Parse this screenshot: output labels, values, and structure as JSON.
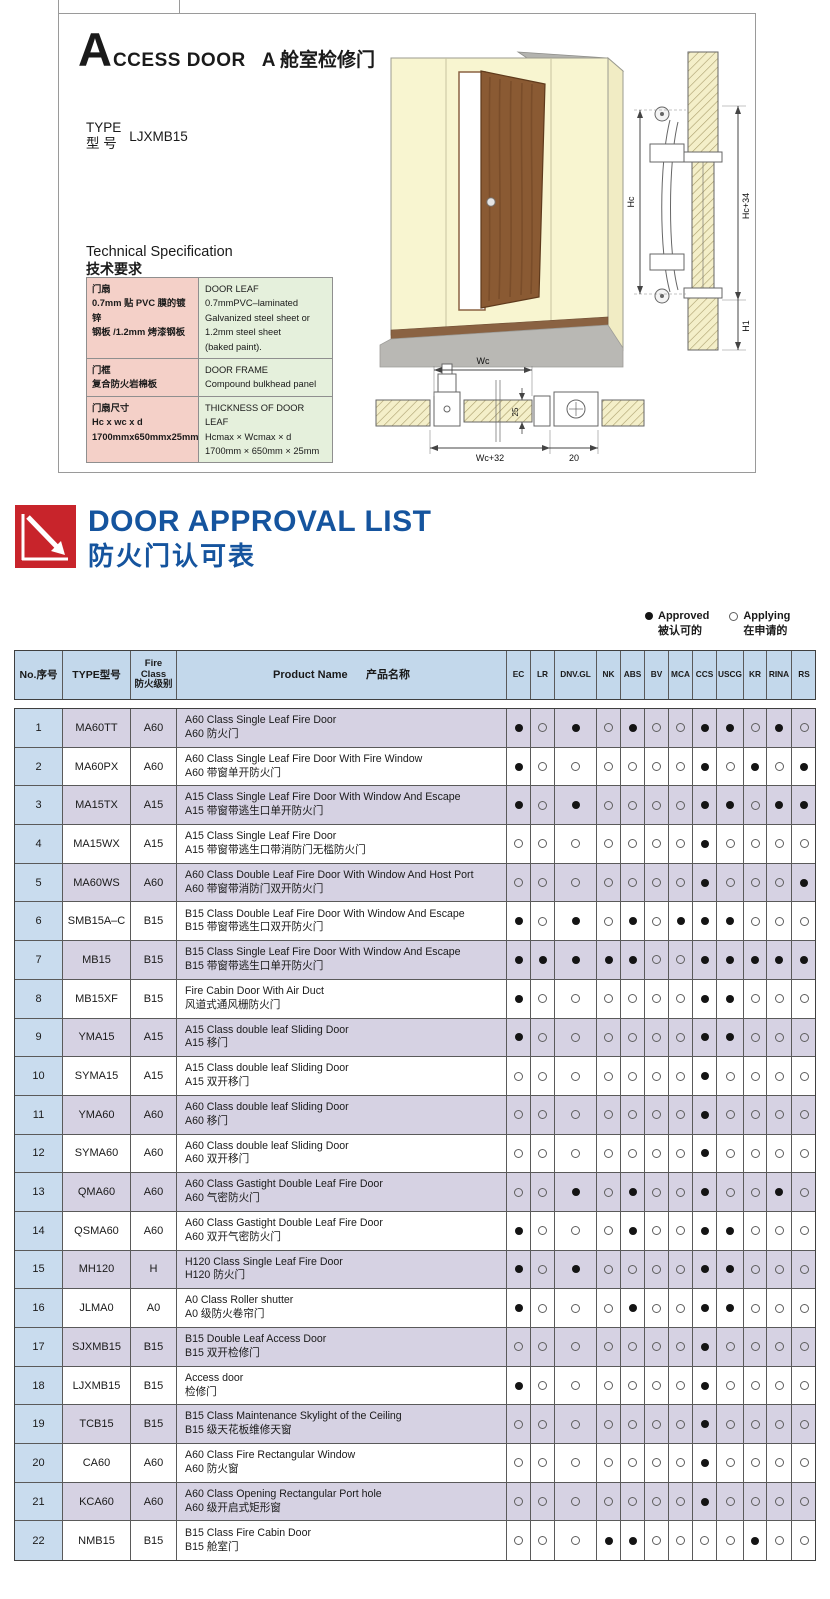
{
  "access_door": {
    "initial": "A",
    "title_en": "CCESS DOOR",
    "title_cn": "A 舱室检修门",
    "type_label_en": "TYPE",
    "type_label_cn": "型  号",
    "type_value": "LJXMB15",
    "spec_title_en": "Technical Specification",
    "spec_title_cn": "技术要求",
    "spec_rows": [
      {
        "cn": "门扇\n0.7mm 贴 PVC 膜的镀锌\n钢板 /1.2mm 烤漆钢板",
        "en": "DOOR LEAF\n0.7mmPVC–laminated\nGalvanized steel sheet or\n1.2mm steel sheet\n(baked paint)."
      },
      {
        "cn": "门框\n复合防火岩棉板",
        "en": "DOOR FRAME\nCompound bulkhead panel"
      },
      {
        "cn": "门扇尺寸\nHc x wc x d\n1700mmx650mmx25mm",
        "en": "THICKNESS OF DOOR LEAF\nHcmax × Wcmax × d\n1700mm × 650mm × 25mm"
      }
    ],
    "dims": {
      "hc": "Hc",
      "hc_plus": "Hc+34",
      "h1": "H1",
      "wc": "Wc",
      "thickness": "25",
      "wc_plus": "Wc+32",
      "edge": "20"
    }
  },
  "approval": {
    "title_en": "DOOR APPROVAL LIST",
    "title_cn": "防火门认可表",
    "legend": {
      "approved_en": "Approved",
      "approved_cn": "被认可的",
      "applying_en": "Applying",
      "applying_cn": "在申请的"
    },
    "header": {
      "no": "No.序号",
      "type": "TYPE型号",
      "fire_class": "Fire\nClass\n防火级别",
      "product": "Product Name      产品名称"
    },
    "certs": [
      "EC",
      "LR",
      "DNV.GL",
      "NK",
      "ABS",
      "BV",
      "MCA",
      "CCS",
      "USCG",
      "KR",
      "RINA",
      "RS"
    ],
    "rows": [
      {
        "no": "1",
        "type": "MA60TT",
        "fire": "A60",
        "en": "A60 Class Single Leaf Fire Door",
        "cn": "A60 防火门",
        "marks": [
          1,
          0,
          1,
          0,
          1,
          0,
          0,
          1,
          1,
          0,
          1,
          0
        ]
      },
      {
        "no": "2",
        "type": "MA60PX",
        "fire": "A60",
        "en": "A60 Class Single Leaf Fire Door With Fire Window",
        "cn": "A60 带窗单开防火门",
        "marks": [
          1,
          0,
          0,
          0,
          0,
          0,
          0,
          1,
          0,
          1,
          0,
          1
        ]
      },
      {
        "no": "3",
        "type": "MA15TX",
        "fire": "A15",
        "en": "A15 Class Single Leaf Fire Door With Window And Escape",
        "cn": "A15 带窗带逃生口单开防火门",
        "marks": [
          1,
          0,
          1,
          0,
          0,
          0,
          0,
          1,
          1,
          0,
          1,
          1
        ]
      },
      {
        "no": "4",
        "type": "MA15WX",
        "fire": "A15",
        "en": "A15 Class Single Leaf Fire Door",
        "cn": "A15 带窗带逃生口带消防门无槛防火门",
        "marks": [
          0,
          0,
          0,
          0,
          0,
          0,
          0,
          1,
          0,
          0,
          0,
          0
        ]
      },
      {
        "no": "5",
        "type": "MA60WS",
        "fire": "A60",
        "en": "A60 Class Double Leaf Fire Door With Window And Host Port",
        "cn": "A60 带窗带消防门双开防火门",
        "marks": [
          0,
          0,
          0,
          0,
          0,
          0,
          0,
          1,
          0,
          0,
          0,
          1
        ]
      },
      {
        "no": "6",
        "type": "SMB15A–C",
        "fire": "B15",
        "en": "B15 Class Double Leaf Fire Door With Window And Escape",
        "cn": "B15 带窗带逃生口双开防火门",
        "marks": [
          1,
          0,
          1,
          0,
          1,
          0,
          1,
          1,
          1,
          0,
          0,
          0
        ]
      },
      {
        "no": "7",
        "type": "MB15",
        "fire": "B15",
        "en": "B15 Class Single Leaf Fire Door With Window And Escape",
        "cn": "B15 带窗带逃生口单开防火门",
        "marks": [
          1,
          1,
          1,
          1,
          1,
          0,
          0,
          1,
          1,
          1,
          1,
          1
        ]
      },
      {
        "no": "8",
        "type": "MB15XF",
        "fire": "B15",
        "en": "Fire Cabin Door With Air Duct",
        "cn": "风道式通风栅防火门",
        "marks": [
          1,
          0,
          0,
          0,
          0,
          0,
          0,
          1,
          1,
          0,
          0,
          0
        ]
      },
      {
        "no": "9",
        "type": "YMA15",
        "fire": "A15",
        "en": "A15 Class double leaf Sliding Door",
        "cn": "A15 移门",
        "marks": [
          1,
          0,
          0,
          0,
          0,
          0,
          0,
          1,
          1,
          0,
          0,
          0
        ]
      },
      {
        "no": "10",
        "type": "SYMA15",
        "fire": "A15",
        "en": "A15 Class double leaf Sliding Door",
        "cn": "A15 双开移门",
        "marks": [
          0,
          0,
          0,
          0,
          0,
          0,
          0,
          1,
          0,
          0,
          0,
          0
        ]
      },
      {
        "no": "11",
        "type": "YMA60",
        "fire": "A60",
        "en": "A60 Class double leaf Sliding Door",
        "cn": "A60 移门",
        "marks": [
          0,
          0,
          0,
          0,
          0,
          0,
          0,
          1,
          0,
          0,
          0,
          0
        ]
      },
      {
        "no": "12",
        "type": "SYMA60",
        "fire": "A60",
        "en": "A60 Class double leaf Sliding Door",
        "cn": "A60 双开移门",
        "marks": [
          0,
          0,
          0,
          0,
          0,
          0,
          0,
          1,
          0,
          0,
          0,
          0
        ]
      },
      {
        "no": "13",
        "type": "QMA60",
        "fire": "A60",
        "en": "A60 Class Gastight Double Leaf Fire Door",
        "cn": "A60 气密防火门",
        "marks": [
          0,
          0,
          1,
          0,
          1,
          0,
          0,
          1,
          0,
          0,
          1,
          0
        ]
      },
      {
        "no": "14",
        "type": "QSMA60",
        "fire": "A60",
        "en": "A60 Class Gastight Double Leaf Fire Door",
        "cn": "A60 双开气密防火门",
        "marks": [
          1,
          0,
          0,
          0,
          1,
          0,
          0,
          1,
          1,
          0,
          0,
          0
        ]
      },
      {
        "no": "15",
        "type": "MH120",
        "fire": "H",
        "en": "H120 Class Single Leaf Fire Door",
        "cn": "H120 防火门",
        "marks": [
          1,
          0,
          1,
          0,
          0,
          0,
          0,
          1,
          1,
          0,
          0,
          0
        ]
      },
      {
        "no": "16",
        "type": "JLMA0",
        "fire": "A0",
        "en": "A0 Class Roller shutter",
        "cn": "A0 级防火卷帘门",
        "marks": [
          1,
          0,
          0,
          0,
          1,
          0,
          0,
          1,
          1,
          0,
          0,
          0
        ]
      },
      {
        "no": "17",
        "type": "SJXMB15",
        "fire": "B15",
        "en": "B15  Double Leaf Access Door",
        "cn": "B15 双开检修门",
        "marks": [
          0,
          0,
          0,
          0,
          0,
          0,
          0,
          1,
          0,
          0,
          0,
          0
        ]
      },
      {
        "no": "18",
        "type": "LJXMB15",
        "fire": "B15",
        "en": "Access door",
        "cn": "检修门",
        "marks": [
          1,
          0,
          0,
          0,
          0,
          0,
          0,
          1,
          0,
          0,
          0,
          0
        ]
      },
      {
        "no": "19",
        "type": "TCB15",
        "fire": "B15",
        "en": "B15 Class Maintenance Skylight of the Ceiling",
        "cn": "B15 级天花板维修天窗",
        "marks": [
          0,
          0,
          0,
          0,
          0,
          0,
          0,
          1,
          0,
          0,
          0,
          0
        ]
      },
      {
        "no": "20",
        "type": "CA60",
        "fire": "A60",
        "en": "A60 Class Fire Rectangular Window",
        "cn": "A60 防火窗",
        "marks": [
          0,
          0,
          0,
          0,
          0,
          0,
          0,
          1,
          0,
          0,
          0,
          0
        ]
      },
      {
        "no": "21",
        "type": "KCA60",
        "fire": "A60",
        "en": "A60 Class  Opening Rectangular Port hole",
        "cn": "A60 级开启式矩形窗",
        "marks": [
          0,
          0,
          0,
          0,
          0,
          0,
          0,
          1,
          0,
          0,
          0,
          0
        ]
      },
      {
        "no": "22",
        "type": "NMB15",
        "fire": "B15",
        "en": "B15 Class Fire Cabin Door",
        "cn": "B15 舱室门",
        "marks": [
          0,
          0,
          0,
          1,
          1,
          0,
          0,
          0,
          0,
          1,
          0,
          0
        ]
      }
    ]
  },
  "colors": {
    "accent_blue": "#15549e",
    "logo_red": "#c8242b",
    "table_header_bg": "#c3d8eb",
    "row_alt_bg": "#d6d2e3",
    "no_col_bg": "#c9dcee",
    "spec_cn_bg": "#f4d0c8",
    "spec_en_bg": "#e5f0dc"
  }
}
